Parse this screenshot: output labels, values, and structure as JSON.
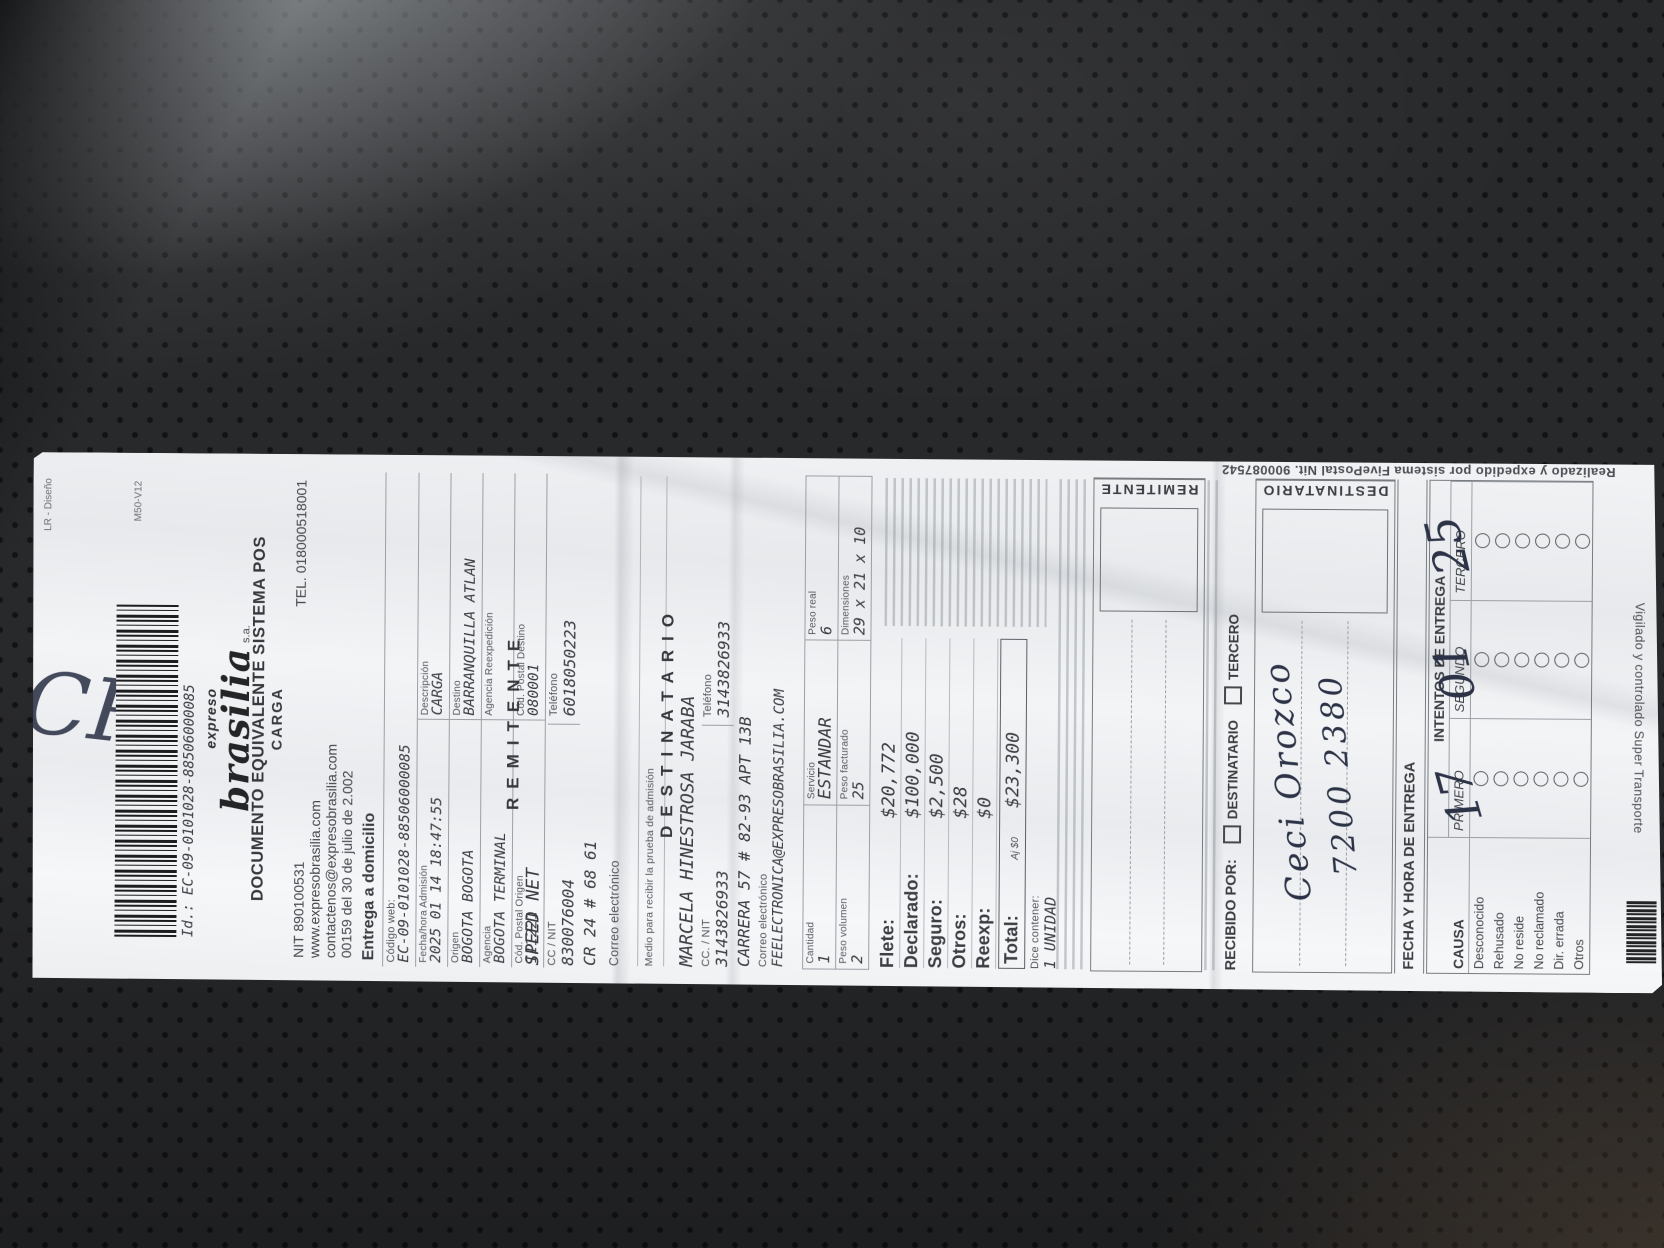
{
  "colors": {
    "paper": "#f0f1f3",
    "ink": "#3c3f44",
    "leather_background": "#28292b",
    "handwriting_ink": "#2c3347"
  },
  "receipt": {
    "top_meta_left": "LR - Diseño",
    "top_meta_right": "M50-V12",
    "barcode_caption": "Id.: EC-09-0101028-88506000085",
    "brand_pre": "expreso",
    "brand_name": "brasilia",
    "brand_suffix": "s.a.",
    "title_line1": "DOCUMENTO EQUIVALENTE SISTEMA POS",
    "title_line2": "CARGA",
    "nit": "NIT 890100531",
    "tel": "TEL. 018000518001",
    "website": "www.expresobrasilia.com",
    "contact_email": "contactenos@expresobrasilia.com",
    "resolution_line": "00159 del 30 de julio de 2.002",
    "service_type": "Entrega a domicilio",
    "codigo_web_label": "Código web:",
    "codigo_web_value": "EC-09-0101028-88506000085",
    "admission": {
      "fecha_label": "Fecha/hora Admisión",
      "fecha_value": "2025 01 14 18:47:55",
      "descripcion_label": "Descripción",
      "descripcion_value": "CARGA",
      "origen_label": "Origen",
      "origen_value": "BOGOTA BOGOTA",
      "destino_label": "Destino",
      "destino_value": "BARRANQUILLA ATLAN",
      "agencia_label": "Agencia",
      "agencia_value": "BOGOTA TERMINAL",
      "reexpedicion_label": "Agencia Reexpedición",
      "reexpedicion_value": "",
      "cp_origen_label": "Cód. Postal Origen",
      "cp_origen_value": "111221",
      "cp_destino_label": "Cód. Postal Destino",
      "cp_destino_value": "080001"
    },
    "remitente": {
      "title": "REMITENTE",
      "nombre": "SPEED NET",
      "ccnit_label": "CC / NIT",
      "ccnit": "830076004",
      "tel_label": "Teléfono",
      "tel": "6018050223",
      "direccion": "CR 24 # 68 61",
      "correo_label": "Correo electrónico",
      "medio_label": "Medio para recibir la prueba de admisión"
    },
    "destinatario": {
      "title": "DESTINATARIO",
      "nombre": "MARCELA HINESTROSA JARABA",
      "ccnit_label": "CC. / NIT",
      "ccnit": "3143826933",
      "tel_label": "Teléfono",
      "tel": "3143826933",
      "direccion": "CARRERA 57 # 82-93 APT 13B",
      "correo_label": "Correo electrónico",
      "correo": "FEELECTRONICA@EXPRESOBRASILIA.COM"
    },
    "paquete": {
      "cantidad_label": "Cantidad",
      "cantidad": "1",
      "servicio_label": "Servicio",
      "servicio": "ESTANDAR",
      "peso_real_label": "Peso real",
      "peso_real": "6",
      "peso_vol_label": "Peso volumen",
      "peso_vol": "2",
      "peso_fact_label": "Peso facturado",
      "peso_fact": "25",
      "dim_label": "Dimensiones",
      "dim": "29 x 21 x 10"
    },
    "cobros": {
      "flete_label": "Flete:",
      "flete": "$20,772",
      "declarado_label": "Declarado:",
      "declarado": "$100,000",
      "seguro_label": "Seguro:",
      "seguro": "$2,500",
      "otros_label": "Otros:",
      "otros": "$28",
      "reexp_label": "Reexp:",
      "reexp": "$0",
      "total_label": "Total:",
      "total_note": "Aj $0",
      "total": "$23,300",
      "dice_label": "Dice contener:",
      "dice": "1 UNIDAD"
    },
    "firmas": {
      "remitente_box_label": "REMITENTE",
      "destinatario_box_label": "DESTINATARIO",
      "recibido_label": "RECIBIDO POR:",
      "opcion_destinatario": "DESTINATARIO",
      "opcion_tercero": "TERCERO",
      "fecha_entrega_label": "FECHA Y HORA DE ENTREGA"
    },
    "intentos": {
      "title": "INTENTOS DE ENTREGA",
      "causa_label": "CAUSA",
      "col1": "PRIMERO",
      "col2": "SEGUNDO",
      "col3": "TERCERO",
      "causas": [
        "Desconocido",
        "Rehusado",
        "No reside",
        "No reclamado",
        "Dir. errada",
        "Otros"
      ]
    },
    "bordes": {
      "lateral": "Realizado y expedido por sistema FivePostal Nit. 900087542",
      "inferior": "Vigilado y controlado Super Transporte"
    },
    "manuscrito": {
      "marca_superior": "CR",
      "recibido_nombre": "Ceci Orozco",
      "recibido_doc": "7200 2380",
      "fecha_dia": "17",
      "fecha_mes": "01",
      "fecha_ano": "25"
    }
  }
}
